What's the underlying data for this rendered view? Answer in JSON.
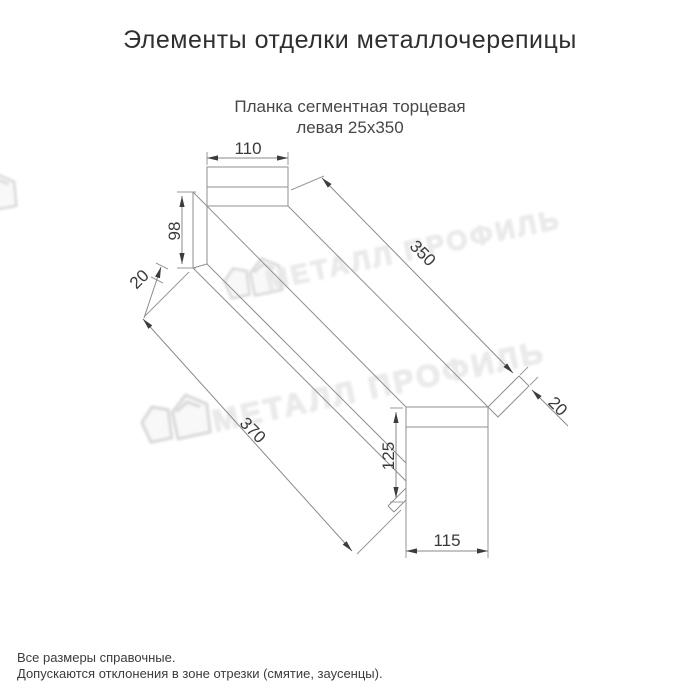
{
  "page": {
    "title": "Элементы отделки металлочерепицы"
  },
  "product": {
    "subtitle_line1": "Планка сегментная торцевая",
    "subtitle_line2": "левая 25x350"
  },
  "drawing": {
    "dimensions": {
      "top_flange_width": "110",
      "left_end_height": "98",
      "left_hem": "20",
      "length_top": "350",
      "length_bottom": "370",
      "right_hem": "20",
      "end_view_height": "125",
      "end_view_width": "115"
    }
  },
  "watermark": {
    "brand_text": "МЕТАЛЛ ПРОФИЛЬ"
  },
  "footer": {
    "note1": "Все размеры справочные.",
    "note2": "Допускаются отклонения в зоне отрезки (смятие, заусенцы)."
  },
  "colors": {
    "line": "#8f8f8f",
    "arrow": "#3c3c3c",
    "dimension_text": "#3a3a3a",
    "watermark": "#e0e0e0",
    "background": "#ffffff"
  }
}
